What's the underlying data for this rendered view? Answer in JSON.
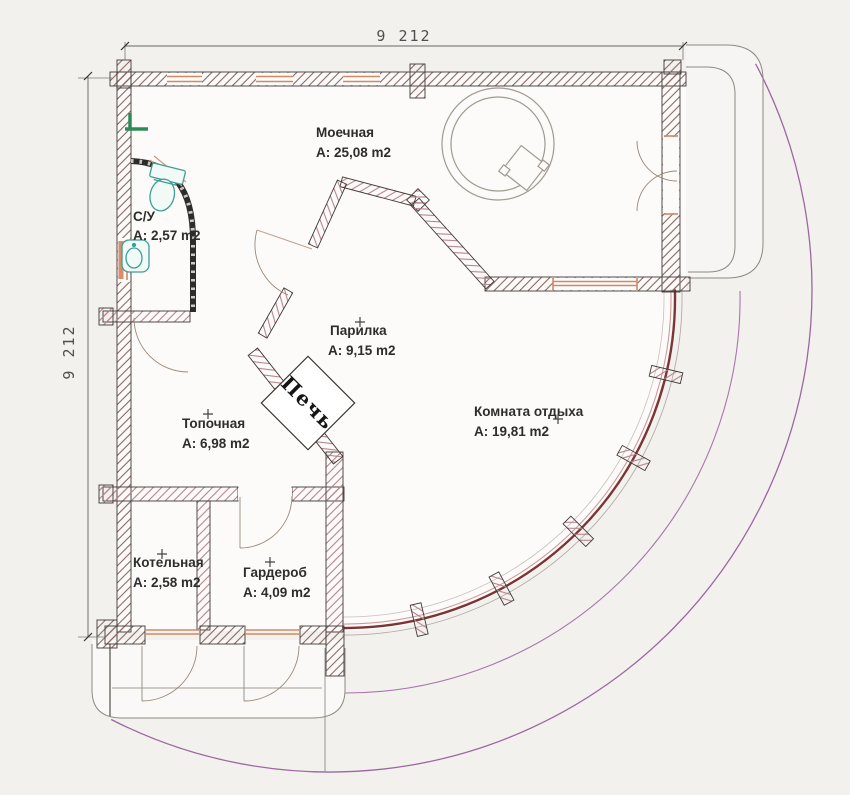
{
  "plan": {
    "title": "Bath house floor plan",
    "dimensions": {
      "top": "9 212",
      "left": "9 212"
    },
    "rooms": [
      {
        "id": "moechnaya",
        "name": "Моечная",
        "area": "A: 25,08 m2"
      },
      {
        "id": "su",
        "name": "С/У",
        "area": "A: 2,57 m2"
      },
      {
        "id": "parilka",
        "name": "Парилка",
        "area": "A: 9,15 m2"
      },
      {
        "id": "komnata-otdyha",
        "name": "Комната отдыха",
        "area": "A: 19,81 m2"
      },
      {
        "id": "topochnaya",
        "name": "Топочная",
        "area": "A: 6,98 m2"
      },
      {
        "id": "kotelnaya",
        "name": "Котельная",
        "area": "A: 2,58 m2"
      },
      {
        "id": "garderob",
        "name": "Гардероб",
        "area": "A: 4,09 m2"
      }
    ],
    "stove": {
      "label": "Печь"
    },
    "colors": {
      "background": "#f2f1ee",
      "floor": "#fcfbf9",
      "wall_outline": "#3f3a37",
      "wall_hatch_exterior": "#8a6862",
      "wall_hatch_interior": "#b5848d",
      "window": "#cf8a64",
      "veranda_arc": "#8d4f93",
      "glass_wall": "#7c3434",
      "fixture_teal": "#3f9e92",
      "fixture_green": "#2e8b57",
      "dimension_text": "#4f4f4f"
    }
  }
}
